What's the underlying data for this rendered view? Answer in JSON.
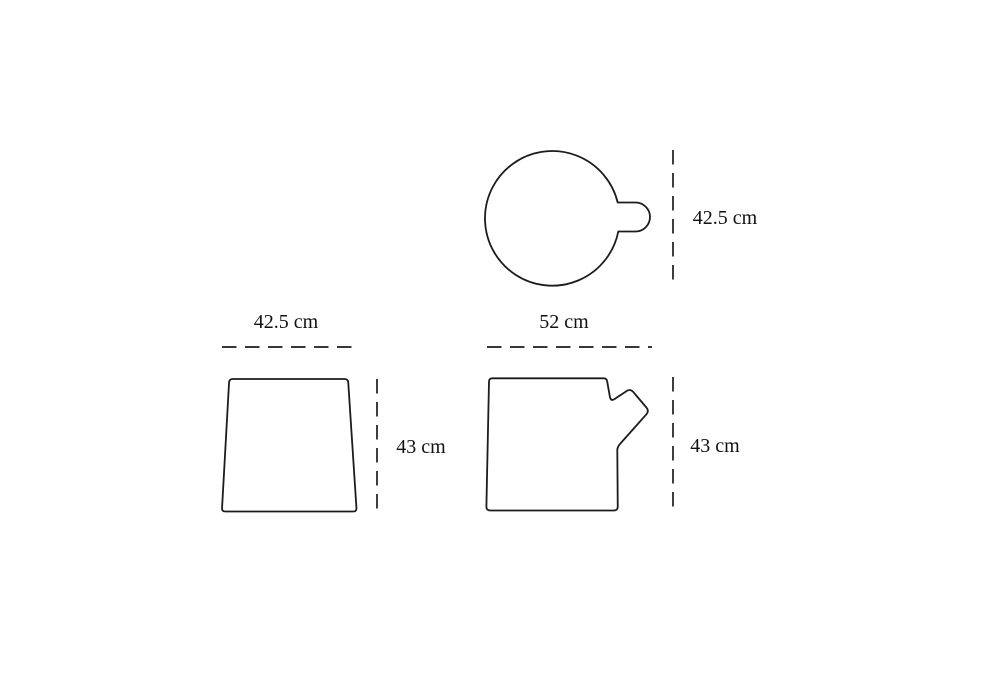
{
  "diagram": {
    "unit": "cm",
    "colors": {
      "line": "#1c1c1c",
      "text": "#111111",
      "background": "#ffffff"
    },
    "views": {
      "top": {
        "height": {
          "label": "42.5 cm",
          "value_cm": 42.5
        }
      },
      "front": {
        "width": {
          "label": "42.5 cm",
          "value_cm": 42.5
        },
        "height": {
          "label": "43 cm",
          "value_cm": 43
        }
      },
      "side": {
        "width": {
          "label": "52 cm",
          "value_cm": 52
        },
        "height": {
          "label": "43 cm",
          "value_cm": 43
        }
      }
    }
  }
}
